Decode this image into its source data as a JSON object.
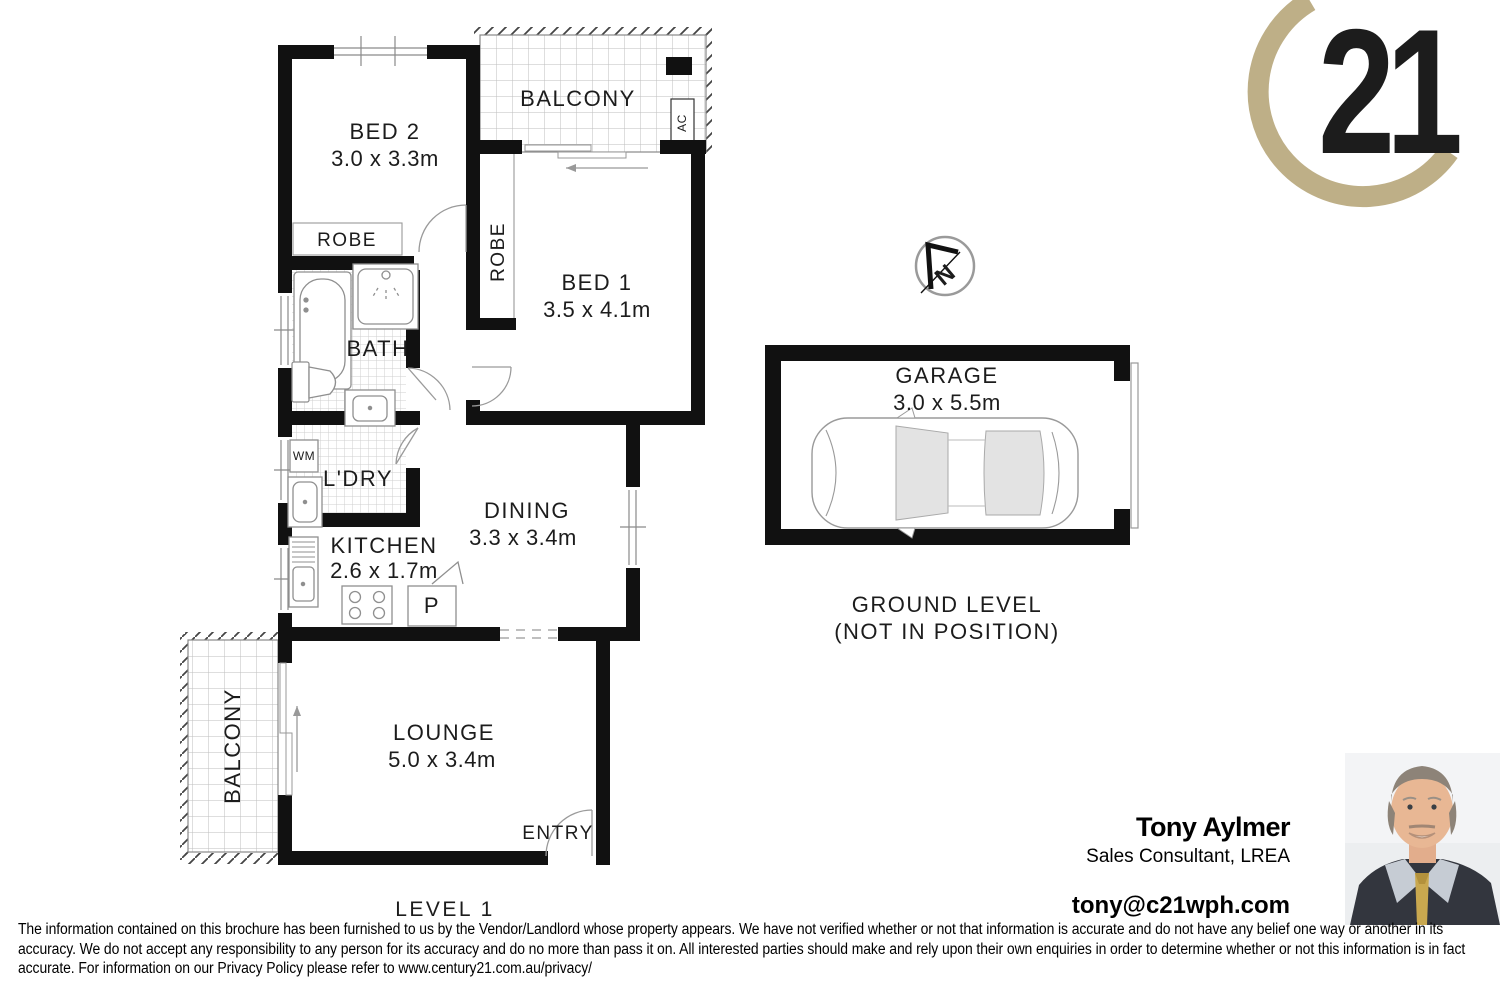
{
  "brand": {
    "number": "21",
    "gold": "#BEAF87"
  },
  "plan": {
    "level": "LEVEL 1",
    "compass_n": "N",
    "bed2": {
      "name": "BED 2",
      "dims": "3.0 x 3.3m"
    },
    "bed1": {
      "name": "BED 1",
      "dims": "3.5 x 4.1m"
    },
    "balcony_top": "BALCONY",
    "balcony_left": "BALCONY",
    "robe_bed2": "ROBE",
    "robe_bed1": "ROBE",
    "bath": "BATH",
    "wm": "WM",
    "laundry": "L'DRY",
    "kitchen": {
      "name": "KITCHEN",
      "dims": "2.6 x 1.7m"
    },
    "pantry": "P",
    "dining": {
      "name": "DINING",
      "dims": "3.3 x 3.4m"
    },
    "lounge": {
      "name": "LOUNGE",
      "dims": "5.0 x 3.4m"
    },
    "entry": "ENTRY",
    "ac": "AC"
  },
  "garage": {
    "name": "GARAGE",
    "dims": "3.0 x 5.5m",
    "ground1": "GROUND LEVEL",
    "ground2": "(NOT IN POSITION)"
  },
  "agent": {
    "name": "Tony Aylmer",
    "title": "Sales Consultant, LREA",
    "email": "tony@c21wph.com"
  },
  "disclaimer": {
    "text": "The information contained on this brochure has been furnished to us by the Vendor/Landlord whose property appears. We have not verified whether or not that information is accurate and do not have any belief one way or another in its accuracy. We do not accept any responsibility to any person for its accuracy and do no more than pass it on. All interested parties should make and rely upon their own enquiries in order to determine whether or not this information is in fact accurate. For information on our Privacy Policy please refer to www.century21.com.au/privacy/"
  }
}
